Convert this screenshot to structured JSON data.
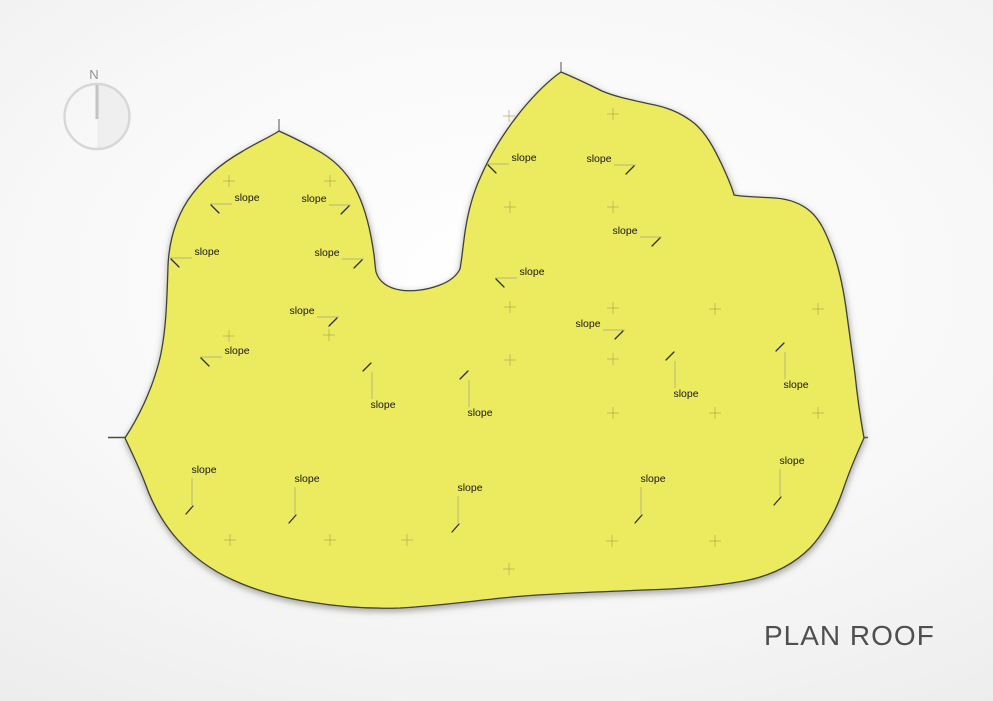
{
  "title": "PLAN ROOF",
  "compass": {
    "label": "N"
  },
  "roof": {
    "slope_label_text": "slope",
    "slope_labels": [
      {
        "x": 247,
        "y": 201,
        "dir": "left"
      },
      {
        "x": 207,
        "y": 255,
        "dir": "left"
      },
      {
        "x": 237,
        "y": 354,
        "dir": "left"
      },
      {
        "x": 314,
        "y": 202,
        "dir": "right"
      },
      {
        "x": 327,
        "y": 256,
        "dir": "right"
      },
      {
        "x": 302,
        "y": 314,
        "dir": "right"
      },
      {
        "x": 524,
        "y": 161,
        "dir": "left"
      },
      {
        "x": 532,
        "y": 275,
        "dir": "left"
      },
      {
        "x": 599,
        "y": 162,
        "dir": "right"
      },
      {
        "x": 625,
        "y": 234,
        "dir": "right"
      },
      {
        "x": 588,
        "y": 327,
        "dir": "right"
      },
      {
        "x": 383,
        "y": 408,
        "dir": "up"
      },
      {
        "x": 480,
        "y": 416,
        "dir": "up"
      },
      {
        "x": 686,
        "y": 397,
        "dir": "up"
      },
      {
        "x": 796,
        "y": 388,
        "dir": "up"
      },
      {
        "x": 204,
        "y": 473,
        "dir": "down"
      },
      {
        "x": 307,
        "y": 482,
        "dir": "down"
      },
      {
        "x": 470,
        "y": 491,
        "dir": "down"
      },
      {
        "x": 653,
        "y": 482,
        "dir": "down"
      },
      {
        "x": 792,
        "y": 464,
        "dir": "down"
      }
    ],
    "crosses": [
      [
        229,
        181
      ],
      [
        330,
        181
      ],
      [
        509,
        116
      ],
      [
        613,
        114
      ],
      [
        229,
        336
      ],
      [
        329,
        335
      ],
      [
        510,
        207
      ],
      [
        613,
        207
      ],
      [
        510,
        307
      ],
      [
        613,
        308
      ],
      [
        510,
        360
      ],
      [
        613,
        359
      ],
      [
        715,
        309
      ],
      [
        818,
        309
      ],
      [
        613,
        413
      ],
      [
        715,
        413
      ],
      [
        818,
        413
      ],
      [
        230,
        540
      ],
      [
        330,
        540
      ],
      [
        407,
        540
      ],
      [
        509,
        569
      ],
      [
        612,
        541
      ],
      [
        715,
        541
      ]
    ],
    "eave_ticks": [
      230,
      330,
      407,
      612,
      715
    ],
    "colors": {
      "roof_yellow": "#f0ed5f",
      "roof_pale": "#f5f38e",
      "roof_olive": "#ddd742",
      "outline": "#3f3f37",
      "background": "#e9e9e9",
      "label_text": "#161616",
      "title_text": "#4f4f4f"
    }
  }
}
